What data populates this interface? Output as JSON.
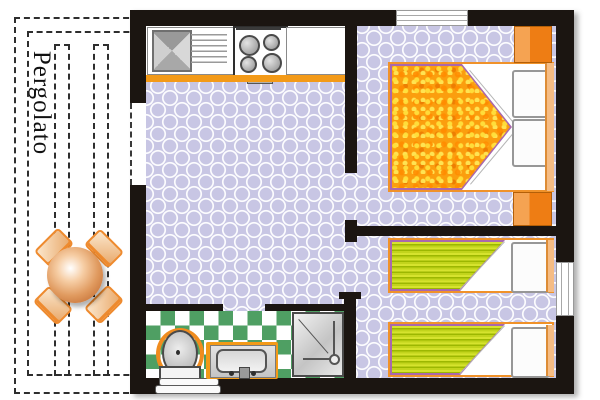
{
  "pergola": {
    "label": "Pergolato",
    "border_style": "dashed",
    "table": {
      "icon": "round-table-icon",
      "color": "#b85c22"
    },
    "chairs": {
      "icon": "chair-icon",
      "count": 4,
      "color": "#ee8a2e"
    }
  },
  "floorplan": {
    "wall_color": "#1b1511",
    "floor_color": "#c8c6e4",
    "floor_pattern": "white lattice of overlapping circles",
    "accent_orange": "#f39a18",
    "rooms": {
      "kitchen_living": {
        "fixtures": [
          "sink-icon",
          "drainboard-icon",
          "stove-icon",
          "counter-icon"
        ],
        "burner_count": 4
      },
      "bedroom_double": {
        "fixtures": [
          "double-bed-icon",
          "pillow-icon",
          "wardrobe-icon"
        ],
        "pillow_count": 2,
        "wardrobe_count": 2,
        "blanket_color": "#fb9e0e"
      },
      "bedroom_twin": {
        "fixtures": [
          "single-bed-icon",
          "pillow-icon"
        ],
        "bed_count": 2,
        "blanket_color": "#c2d41c"
      },
      "bathroom": {
        "fixtures": [
          "toilet-icon",
          "washbasin-icon",
          "shower-icon",
          "steps-icon"
        ],
        "tile_colors": [
          "#4f9f63",
          "#ffffff"
        ]
      }
    },
    "openings": {
      "entrance_doors": 1,
      "windows": 2,
      "interior_doorways": 3
    }
  }
}
